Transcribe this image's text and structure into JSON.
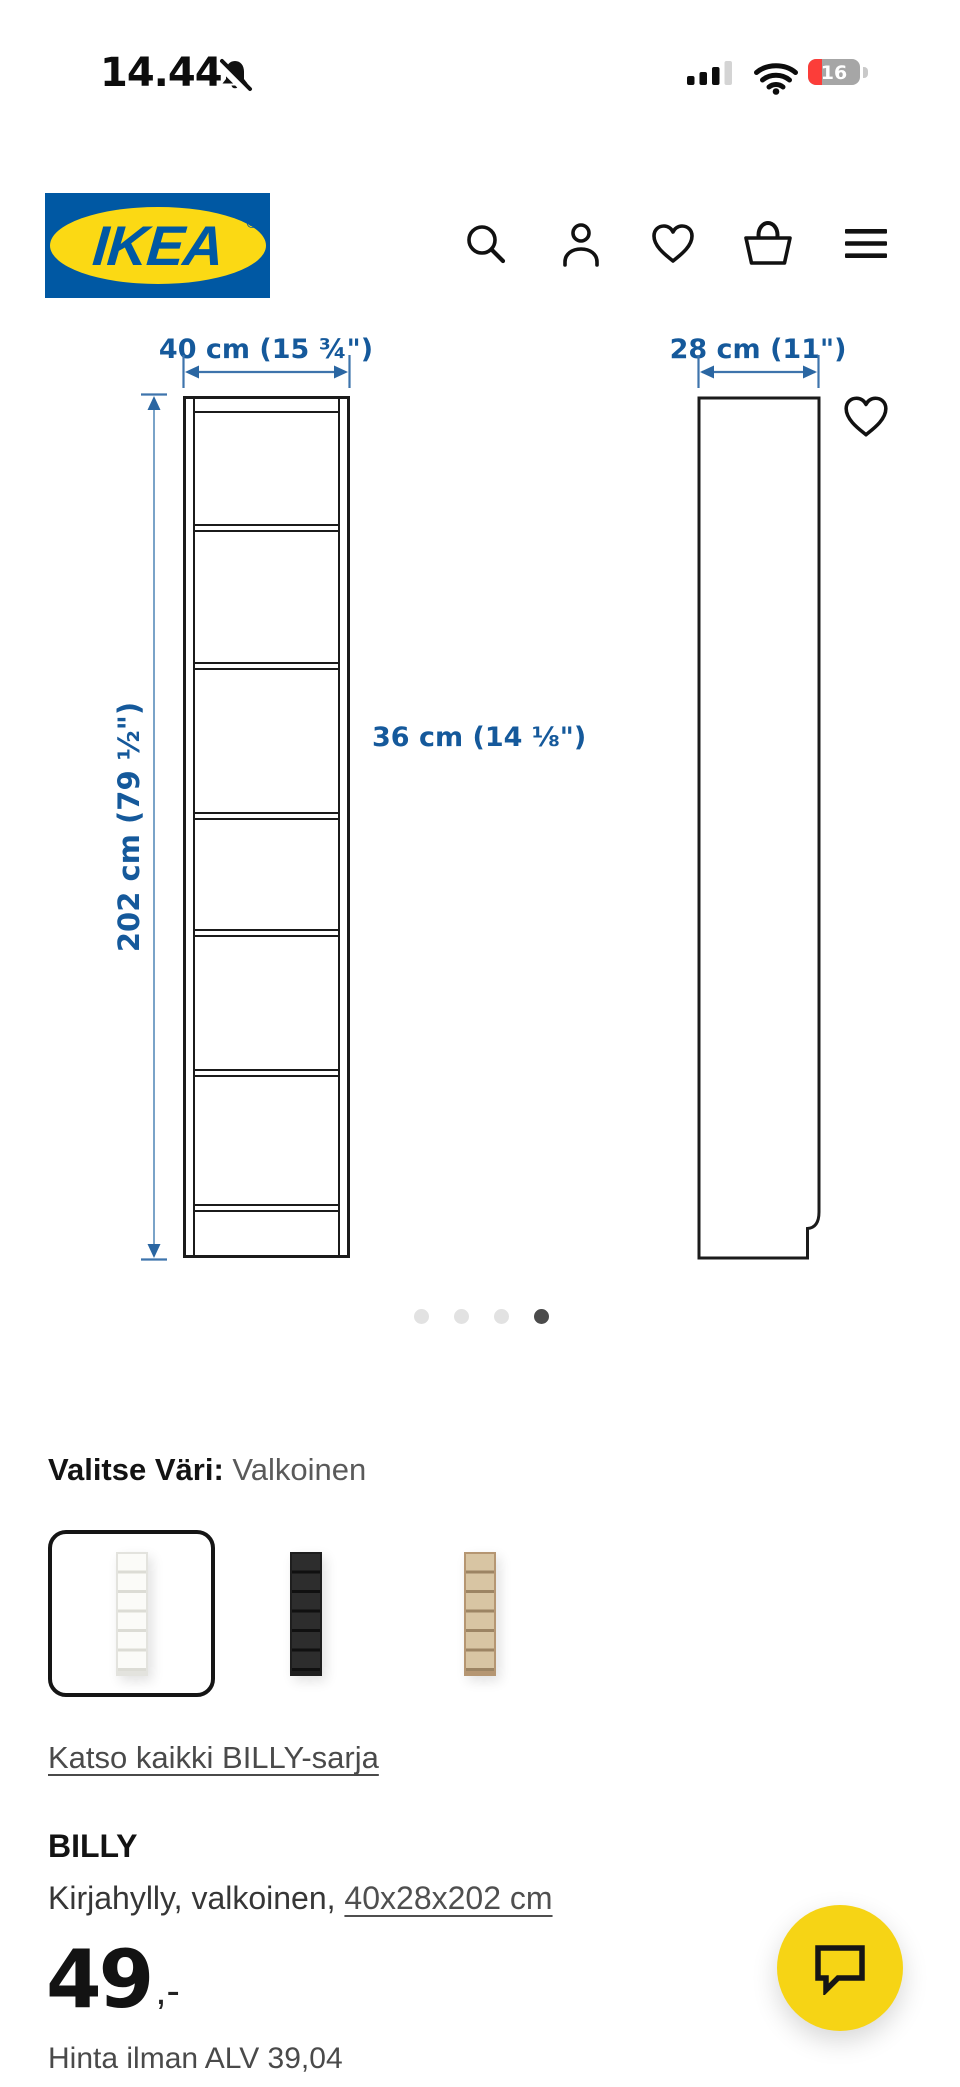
{
  "status_bar": {
    "time": "14.44",
    "battery_level": "16",
    "signal_bars_filled": 3,
    "signal_bars_total": 4
  },
  "header": {
    "logo_text": "IKEA",
    "registered_mark": "®"
  },
  "diagram": {
    "width_label": "40 cm (15 ¾\")",
    "depth_label": "28 cm (11\")",
    "height_label": "202 cm (79 ½\")",
    "inner_width_label": "36 cm (14 ⅛\")"
  },
  "carousel": {
    "dot_count": 4,
    "active_dot": 4
  },
  "color_section": {
    "label": "Valitse Väri:",
    "selected_value": "Valkoinen",
    "options": [
      {
        "frame": "#e3e3de",
        "compartment": "#fbfbf8",
        "shelf": "#dcdcd5",
        "selected": true
      },
      {
        "frame": "#1e1e1e",
        "compartment": "#2d2d2d",
        "shelf": "#101010",
        "selected": false
      },
      {
        "frame": "#b59672",
        "compartment": "#d8c5a3",
        "shelf": "#9c8463",
        "selected": false
      }
    ]
  },
  "series_link_label": "Katso kaikki BILLY-sarja",
  "product": {
    "name": "BILLY",
    "description_prefix": "Kirjahylly, valkoinen, ",
    "dimensions_link": "40x28x202 cm",
    "price_integer": "49",
    "price_suffix": ",-",
    "vat_note": "Hinta ilman ALV 39,04"
  },
  "colors": {
    "brand_blue": "#0058A3",
    "brand_yellow": "#FBD914",
    "dimension_text_blue": "#15599B",
    "dimension_line_blue": "#3E74AC",
    "battery_red": "#FC3D39",
    "chat_button_yellow": "#F6D415",
    "carousel_active": "#4B4B4B",
    "carousel_inactive": "#E2E2E2",
    "drawing_line": "#1B1B1B"
  }
}
